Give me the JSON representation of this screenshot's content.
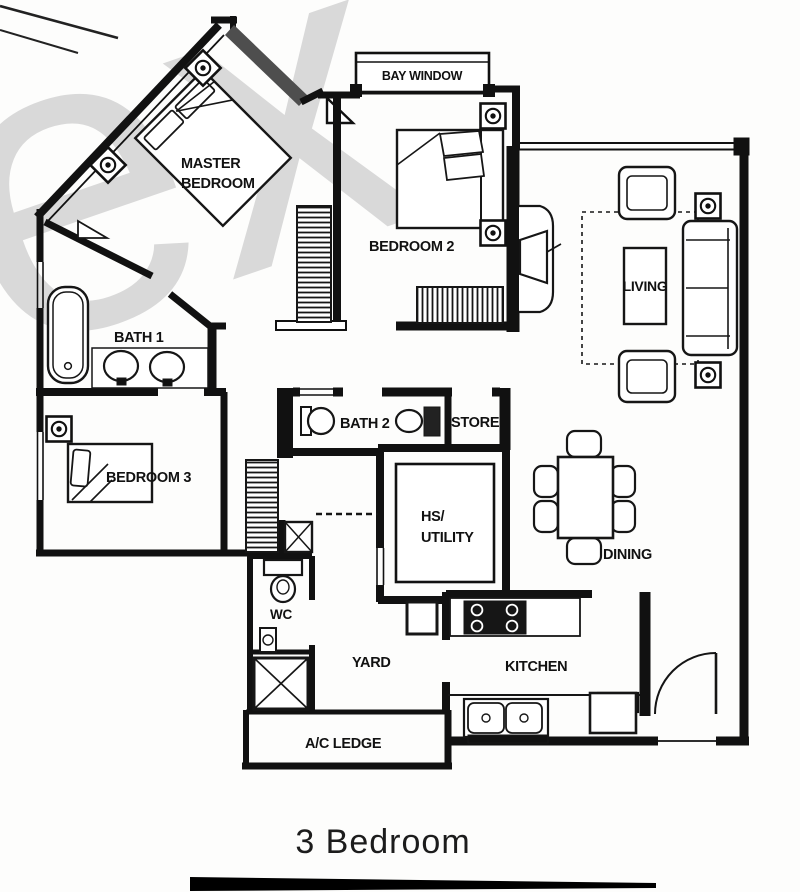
{
  "watermark": "ex",
  "caption": "3 Bedroom",
  "rooms": {
    "bay_window": "BAY WINDOW",
    "master_line1": "MASTER",
    "master_line2": "BEDROOM",
    "bedroom2": "BEDROOM 2",
    "living": "LIVING",
    "bath1": "BATH 1",
    "bath2": "BATH 2",
    "store": "STORE",
    "bedroom3": "BEDROOM 3",
    "hs_line1": "HS/",
    "hs_line2": "UTILITY",
    "dining": "DINING",
    "wc": "WC",
    "yard": "YARD",
    "kitchen": "KITCHEN",
    "ac_ledge": "A/C LEDGE"
  }
}
